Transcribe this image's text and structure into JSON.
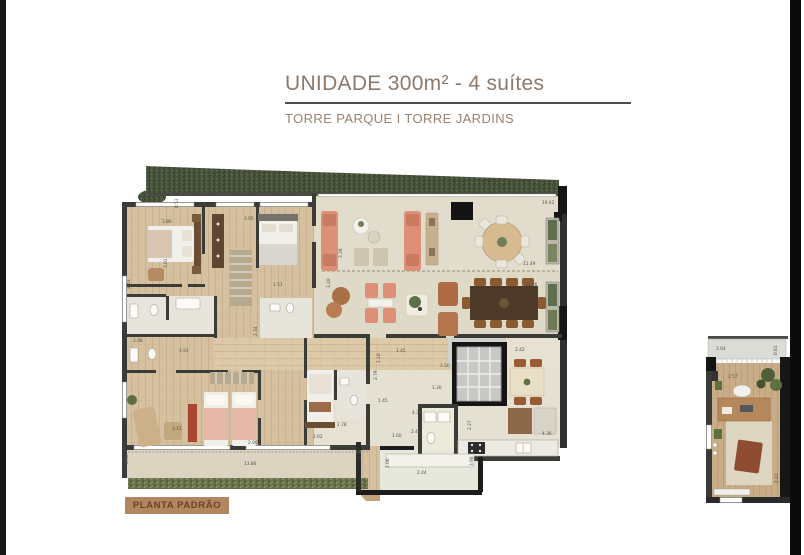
{
  "header": {
    "title": "UNIDADE 300m² - 4 suítes",
    "subtitle": "TORRE PARQUE I TORRE JARDINS"
  },
  "footer": {
    "tag_label": "PLANTA PADRÃO"
  },
  "palette": {
    "title_taupe": "#8c7969",
    "subtitle_taupe": "#97836e",
    "tag_bg": "#b1875f",
    "tag_text": "#6e4128",
    "frame_bar": "#171717",
    "wall_gray": "#3b3b38",
    "wall_black": "#161616",
    "floor_cream": "#e6e1d2",
    "floor_wood": "#d5c19f",
    "hedge_green": "#49543d",
    "sofa_coral": "#dd9077",
    "leather_brown": "#ad6a43",
    "dining_darkwood": "#4e3a28",
    "dimension_text": "#53504a"
  },
  "main_plan": {
    "dimension_labels": [
      {
        "t": "19.42",
        "x": 424,
        "y": 48
      },
      {
        "t": "8.51",
        "x": 60,
        "y": 52,
        "r": -90
      },
      {
        "t": "3.86",
        "x": 44,
        "y": 67
      },
      {
        "t": "3.95",
        "x": 126,
        "y": 64
      },
      {
        "t": "3.01",
        "x": 49,
        "y": 112,
        "r": -90
      },
      {
        "t": "2.43",
        "x": 12,
        "y": 133,
        "r": -90
      },
      {
        "t": "3.39",
        "x": 224,
        "y": 102,
        "r": -90
      },
      {
        "t": "11.49",
        "x": 405,
        "y": 109
      },
      {
        "t": "11.66",
        "x": 407,
        "y": 130
      },
      {
        "t": "1.51",
        "x": 155,
        "y": 130
      },
      {
        "t": "3.28",
        "x": 212,
        "y": 132,
        "r": -90
      },
      {
        "t": "2.08",
        "x": 15,
        "y": 186
      },
      {
        "t": "1.93",
        "x": 61,
        "y": 196
      },
      {
        "t": "2.34",
        "x": 139,
        "y": 180,
        "r": -90
      },
      {
        "t": "2.79",
        "x": 259,
        "y": 224,
        "r": -90
      },
      {
        "t": "1.45",
        "x": 278,
        "y": 196
      },
      {
        "t": "1.10",
        "x": 262,
        "y": 207,
        "r": -90
      },
      {
        "t": "1.50",
        "x": 322,
        "y": 211
      },
      {
        "t": "1.30",
        "x": 314,
        "y": 233
      },
      {
        "t": "2.42",
        "x": 397,
        "y": 195
      },
      {
        "t": "1.45",
        "x": 260,
        "y": 246
      },
      {
        "t": "4.39",
        "x": 294,
        "y": 258
      },
      {
        "t": "2.49",
        "x": 293,
        "y": 277
      },
      {
        "t": "1.60",
        "x": 274,
        "y": 281
      },
      {
        "t": "3.15",
        "x": 54,
        "y": 274
      },
      {
        "t": "2.90",
        "x": 130,
        "y": 288
      },
      {
        "t": "2.62",
        "x": 195,
        "y": 282
      },
      {
        "t": "2.78",
        "x": 219,
        "y": 270
      },
      {
        "t": "13.86",
        "x": 126,
        "y": 309
      },
      {
        "t": "0.98",
        "x": 10,
        "y": 308,
        "r": -90
      },
      {
        "t": "1.73",
        "x": 243,
        "y": 303,
        "r": -90
      },
      {
        "t": "2.06",
        "x": 271,
        "y": 312,
        "r": -90
      },
      {
        "t": "2.44",
        "x": 299,
        "y": 318
      },
      {
        "t": "3.98",
        "x": 355,
        "y": 310,
        "r": -90
      },
      {
        "t": "2.27",
        "x": 353,
        "y": 274,
        "r": -90
      },
      {
        "t": "4.36",
        "x": 424,
        "y": 279
      }
    ]
  },
  "annex_plan": {
    "dimension_labels": [
      {
        "t": "2.64",
        "x": 16,
        "y": 17
      },
      {
        "t": "0.61",
        "x": 77,
        "y": 22,
        "r": -90
      },
      {
        "t": "2.57",
        "x": 28,
        "y": 45
      },
      {
        "t": "4.42",
        "x": 78,
        "y": 150,
        "r": -90
      }
    ]
  }
}
